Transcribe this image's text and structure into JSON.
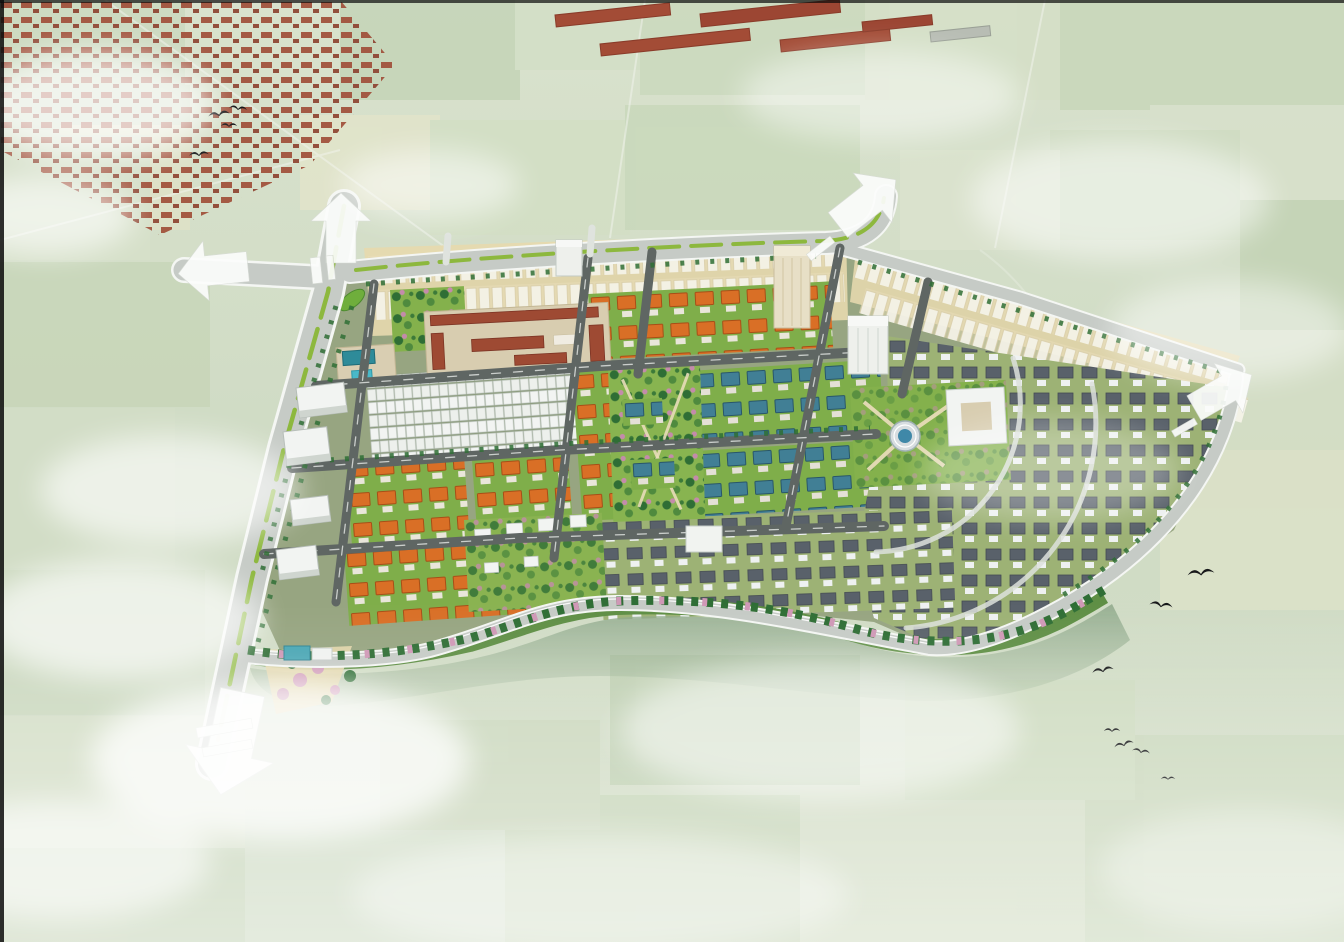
{
  "meta": {
    "type": "aerial-3d-masterplan-rendering",
    "subject": "Bird's-eye architectural visualization of a new residential township composited over a hazy aerial photo of farmland",
    "no_visible_text": true
  },
  "palette": {
    "field_light": "#d6e0c9",
    "field_dark": "#c3d3b5",
    "village_red": "#a1523c",
    "road_light": "#c6cbc6",
    "road_dark": "#5f6663",
    "road_white": "#eef1ee",
    "median_green": "#8db83e",
    "lawn_green": "#7fae4a",
    "park_lawn": "#84b14c",
    "tree_green": "#2f6e35",
    "tree_pink": "#cf98b6",
    "ghost_white": "#f7f4ea",
    "ghost_ground": "#e6d9ae",
    "roof_orange": "#d96f26",
    "roof_teal": "#417f95",
    "roof_slate": "#59616a",
    "roof_school": "#9e4a33",
    "wall_white": "#f2f4f2",
    "water": "#8fa98b",
    "arrow_white": "#fbfcfb",
    "bird_black": "#17181a",
    "tower_beige": "#e7dfc6",
    "pool_teal": "#49b9c9"
  },
  "site": {
    "entry_arrows": [
      {
        "id": "north",
        "direction": "up"
      },
      {
        "id": "west",
        "direction": "left"
      },
      {
        "id": "south",
        "direction": "down"
      },
      {
        "id": "northeast",
        "direction": "up-right"
      },
      {
        "id": "east",
        "direction": "up-right"
      }
    ],
    "districts": [
      {
        "id": "ghost-rows-top",
        "label": "Translucent unbuilt shophouse rows along the northern edge",
        "color_key": "ghost_white"
      },
      {
        "id": "orange-villa-blocks",
        "label": "Orange hip-roof villa blocks (west / center-north)",
        "color_key": "roof_orange"
      },
      {
        "id": "teal-villa-blocks",
        "label": "Teal-roof villa blocks (center)",
        "color_key": "roof_teal"
      },
      {
        "id": "slate-villa-fan",
        "label": "White villas with slate roofs in curved rows (east fan)",
        "color_key": "roof_slate"
      },
      {
        "id": "shophouse-terraces",
        "label": "Long white-roof terraced shophouse rows (center-west)",
        "color_key": "wall_white"
      },
      {
        "id": "apartment-slabs",
        "label": "White mid-rise apartment slabs along the west boulevard",
        "color_key": "wall_white"
      },
      {
        "id": "school-campus",
        "label": "Red-tile school campus with courtyards and teal-roof kindergarten with pool",
        "color_key": "roof_school"
      },
      {
        "id": "central-plaza-park",
        "label": "Park with circular fountain plaza and civic building",
        "color_key": "park_lawn"
      },
      {
        "id": "linear-park",
        "label": "Central linear landscaped park",
        "color_key": "park_lawn"
      },
      {
        "id": "waterfront",
        "label": "Tree-lined lake edge along the southern boundary with pink blossom trees",
        "color_key": "water"
      }
    ],
    "towers": [
      "beige high-rise at north road",
      "white high-rise near center",
      "small white tower at top road"
    ]
  },
  "surroundings": {
    "village": "red-roof hamlet and long warehouse sheds at top-left / top-center",
    "farmland": "pale patchwork fields with faint rural roads",
    "birds_top_left": 4,
    "birds_bottom_right": 7,
    "clouds": 14
  }
}
